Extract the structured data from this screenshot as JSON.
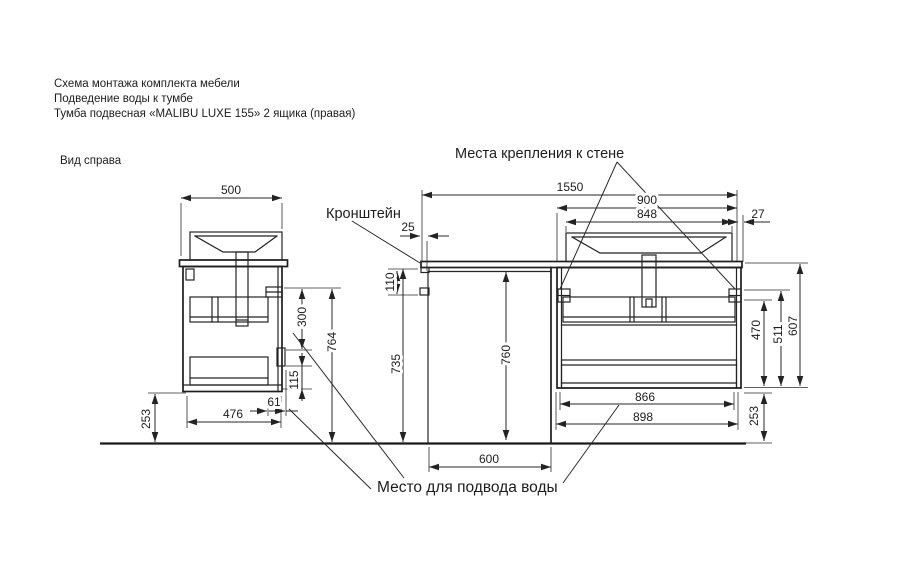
{
  "header": {
    "line1": "Схема монтажа комплекта мебели",
    "line2": "Подведение воды к тумбе",
    "line3": "Тумба подвесная «MALIBU LUXE 155»  2 ящика (правая)"
  },
  "labels": {
    "view_right": "Вид справа",
    "wall_mount": "Места крепления к стене",
    "bracket": "Кронштейн",
    "water_supply": "Место  для подвода воды"
  },
  "dims": {
    "side": {
      "top_width": "500",
      "upper_300": "300",
      "height_764": "764",
      "lower_115": "115",
      "gap_61": "61",
      "bottom_476": "476",
      "floor_253": "253"
    },
    "niche": {
      "offset_25": "25",
      "drop_110": "110",
      "height_735": "735",
      "machine_760": "760",
      "width_600": "600"
    },
    "front": {
      "total_1550": "1550",
      "cabinet_900": "900",
      "sink_848": "848",
      "edge_27": "27",
      "h470": "470",
      "h511": "511",
      "h607": "607",
      "w866": "866",
      "w898": "898",
      "floor_253": "253"
    }
  },
  "drawing": {
    "stroke": "#232323",
    "background": "#ffffff"
  }
}
